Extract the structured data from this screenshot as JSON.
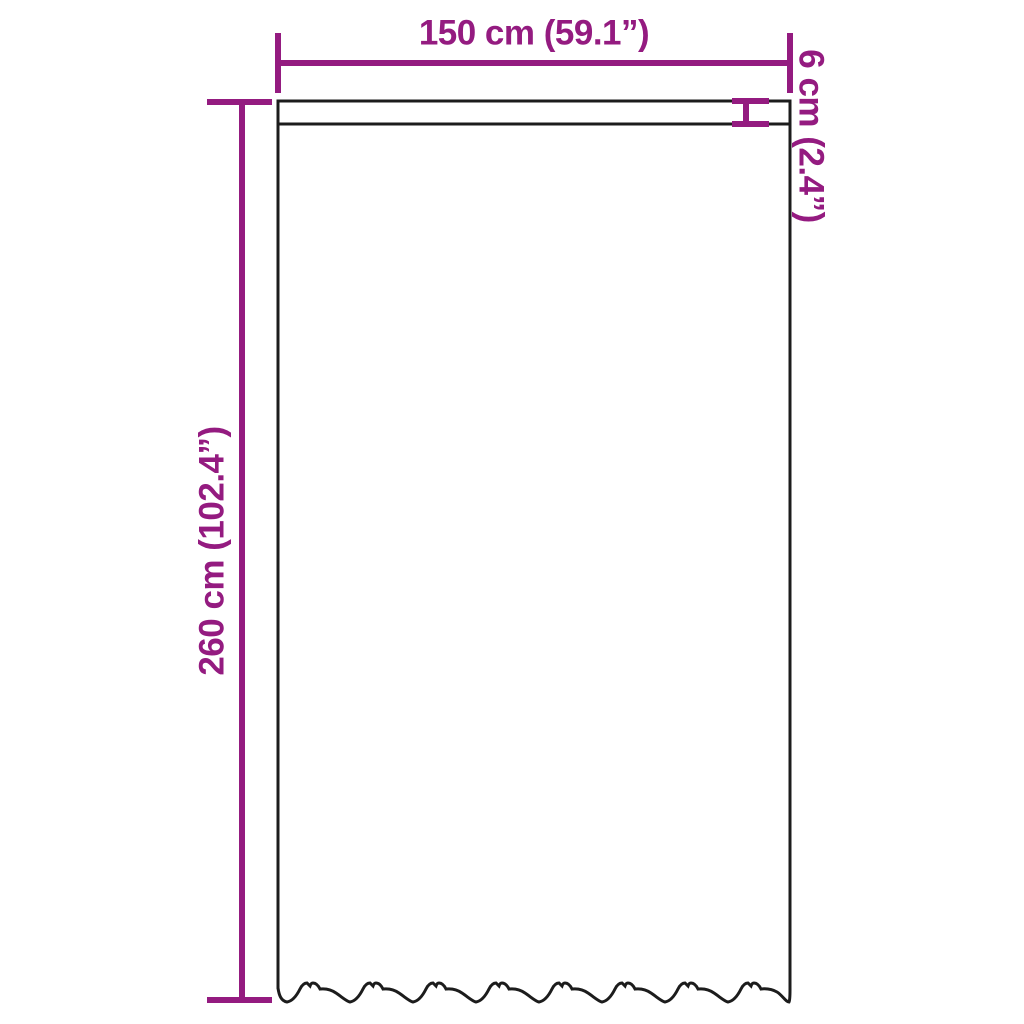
{
  "labels": {
    "width": "150 cm (59.1”)",
    "header": "6 cm (2.4”)",
    "height": "260 cm (102.4”)"
  },
  "colors": {
    "dimension": "#941b80",
    "outline": "#1c1c1c",
    "background": "#ffffff"
  }
}
